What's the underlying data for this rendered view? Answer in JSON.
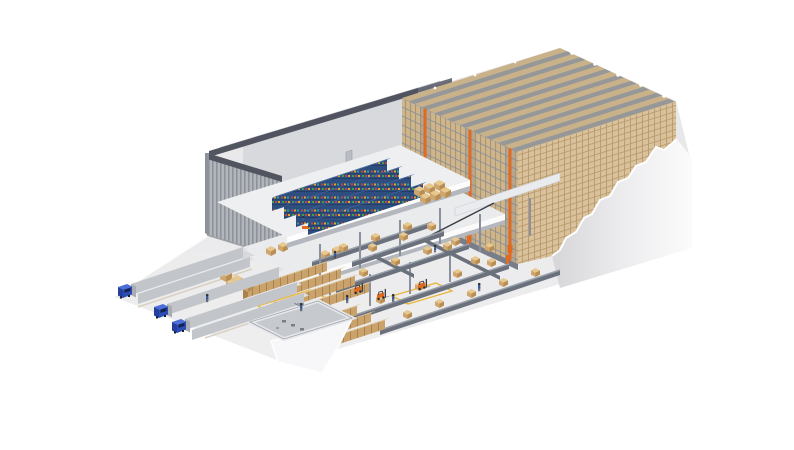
{
  "meta": {
    "title": "Automated warehouse - isometric cutaway illustration",
    "description": "3D cutaway illustration of an automated warehouse: high-bay pallet racking served by orange stacker cranes, a multi-level picking mezzanine with blue bin shelving, pallet conveyor circuits, pallet staging lanes, a sunken service pit, and loading docks with three blue trucks.",
    "canvas_width": 794,
    "canvas_height": 450
  },
  "scene": {
    "racking": {
      "name": "high-bay-racking",
      "rows": 6,
      "stacker_cranes": 3
    },
    "building": {
      "name": "warehouse-shell"
    },
    "mezzanine": {
      "name": "picking-mezzanine",
      "levels": 3,
      "shelf_rows": 4
    },
    "conveyors": {
      "name": "conveyor-circuit",
      "lines": 6
    },
    "docks": {
      "name": "loading-docks",
      "trucks": 3,
      "spare_trailers": 2
    },
    "staging": {
      "name": "pallet-staging",
      "stacks": 7
    },
    "fleet": {
      "forklifts": 3,
      "pallet_trucks": 1
    },
    "people": {
      "workers": 8
    }
  },
  "colors": {
    "bg": "#ffffff",
    "floor": "#e6e6e8",
    "floor_edge": "#ffffff",
    "wall": "#b2b6bc",
    "wall_dark": "#8e939a",
    "trim": "#515560",
    "roof": "#c9ccd0",
    "roof_line": "#b9bcc1",
    "interior_wall": "#d7d9dc",
    "rackface": "#cdb68e",
    "rack_top": "#c9b28a",
    "rack_seam": "#a8906a",
    "rack_line": "#8a919c",
    "box_wall": "#d9c19b",
    "box_seam": "#b89a6e",
    "aisle": "#8b8f99",
    "orange": "#e2691e",
    "slab": "#edeff0",
    "slab_shadow": "#b4b8be",
    "conveyor": "#6b717c",
    "conveyor_top": "#9aa1ab",
    "carton_top": "#e7c88f",
    "carton_left": "#cfa76e",
    "carton_right": "#b98e52",
    "shelf_blue": "#2e4e80",
    "shelf_blue_top": "#42659e",
    "bin_red": "#c4443c",
    "bin_green": "#3a9e55",
    "bin_yellow": "#e0a52e",
    "bin_teal": "#2e9e9a",
    "truck_blue": "#2b4db8",
    "truck_blue_dark": "#24409c",
    "truck_blue_top": "#4a6fd6",
    "glass": "#16214d",
    "trailer": "#c2c5ca",
    "trailer_top": "#dfe1e4",
    "stack_top": "#e0c9a2",
    "stack_front": "#caa36c",
    "stack_seam": "#a8824f",
    "pit_wall": "#e6e7ea",
    "pit_floor": "#c6c9cd",
    "torn": "#f7f7f9",
    "person": "#3a5a9a",
    "marking": "#e8b83a",
    "machine": "#7a7f86"
  }
}
